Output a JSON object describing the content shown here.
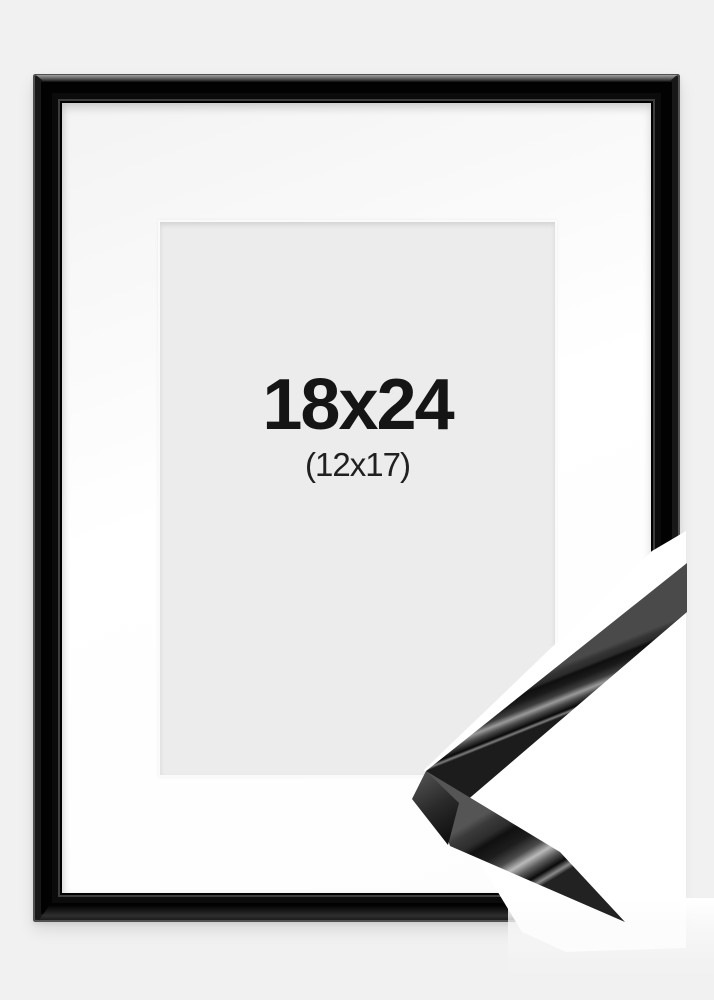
{
  "product_photo": {
    "description": "black picture frame with white mat and corner moulding sample",
    "size_label": "18x24",
    "inner_size_label": "(12x17)",
    "colors": {
      "page_background": "#f1f1f1",
      "frame": "#0a0a0a",
      "frame_highlight": "#9a9a9a",
      "mat": "#ffffff",
      "opening": "#ececec",
      "label_text": "#151515",
      "sample_photo_background": "#ffffff"
    }
  }
}
